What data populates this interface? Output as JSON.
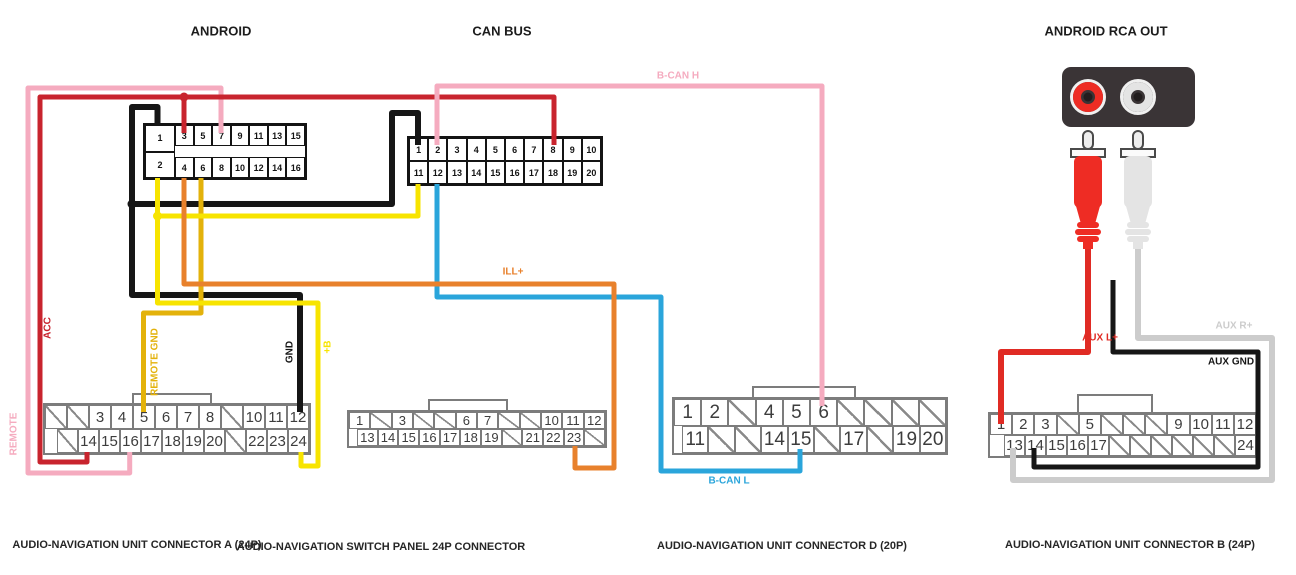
{
  "headers": {
    "android": "ANDROID",
    "can_bus": "CAN BUS",
    "rca_out": "ANDROID RCA OUT"
  },
  "connector_titles": {
    "unit_a": "AUDIO-NAVIGATION UNIT CONNECTOR A (24P)",
    "switch_panel": "AUDIO-NAVIGATION SWITCH PANEL 24P CONNECTOR",
    "unit_d": "AUDIO-NAVIGATION UNIT CONNECTOR D (20P)",
    "unit_b": "AUDIO-NAVIGATION UNIT CONNECTOR B (24P)"
  },
  "connectors": {
    "android": {
      "left_pins": [
        "1",
        "2"
      ],
      "top_row": [
        "3",
        "5",
        "7",
        "9",
        "11",
        "13",
        "15"
      ],
      "bottom_row": [
        "4",
        "6",
        "8",
        "10",
        "12",
        "14",
        "16"
      ]
    },
    "can_bus": {
      "top_row": [
        "1",
        "2",
        "3",
        "4",
        "5",
        "6",
        "7",
        "8",
        "9",
        "10"
      ],
      "bottom_row": [
        "11",
        "12",
        "13",
        "14",
        "15",
        "16",
        "17",
        "18",
        "19",
        "20"
      ]
    },
    "unit_a": {
      "top_row": [
        "/",
        "/",
        "3",
        "4",
        "5",
        "6",
        "7",
        "8",
        "/",
        "10",
        "11",
        "12"
      ],
      "bottom_row": [
        "/",
        "14",
        "15",
        "16",
        "17",
        "18",
        "19",
        "20",
        "/",
        "22",
        "23",
        "24"
      ]
    },
    "switch_panel": {
      "top_row": [
        "1",
        "/",
        "3",
        "/",
        "/",
        "6",
        "7",
        "/",
        "/",
        "10",
        "11",
        "12"
      ],
      "bottom_row": [
        "13",
        "14",
        "15",
        "16",
        "17",
        "18",
        "19",
        "/",
        "21",
        "22",
        "23",
        "/"
      ]
    },
    "unit_d": {
      "top_row": [
        "1",
        "2",
        "/",
        "4",
        "5",
        "6",
        "/",
        "/",
        "/",
        "/"
      ],
      "bottom_row": [
        "11",
        "/",
        "/",
        "14",
        "15",
        "/",
        "17",
        "/",
        "19",
        "20"
      ]
    },
    "unit_b": {
      "top_row": [
        "1",
        "2",
        "3",
        "/",
        "5",
        "/",
        "/",
        "/",
        "9",
        "10",
        "11",
        "12"
      ],
      "bottom_row": [
        "13",
        "14",
        "15",
        "16",
        "17",
        "/",
        "/",
        "/",
        "/",
        "/",
        "/",
        "24"
      ]
    }
  },
  "wires": {
    "acc": {
      "label": "ACC",
      "color": "#c8242e"
    },
    "remote": {
      "label": "REMOTE",
      "color": "#f5abbf"
    },
    "remote_gnd": {
      "label": "REMOTE GND",
      "color": "#e3b20b"
    },
    "gnd": {
      "label": "GND",
      "color": "#161616"
    },
    "plus_b": {
      "label": "+B",
      "color": "#f7e400"
    },
    "b_can_h": {
      "label": "B-CAN H",
      "color": "#f5abbf"
    },
    "ill": {
      "label": "ILL+",
      "color": "#e8812c"
    },
    "b_can_l": {
      "label": "B-CAN L",
      "color": "#2aa5db"
    },
    "aux_l": {
      "label": "AUX L+",
      "color": "#e02b24"
    },
    "aux_r": {
      "label": "AUX R+",
      "color": "#cccccc"
    },
    "aux_gnd": {
      "label": "AUX GND",
      "color": "#161616"
    },
    "black": {
      "color": "#161616"
    }
  },
  "rca": {
    "panel_color": "#3a3436",
    "red_plug_color": "#ee2c24",
    "white_plug_color": "#e4e4e4",
    "metal_color": "#f0f0f0",
    "jack_hole_color": "#221d1e"
  }
}
